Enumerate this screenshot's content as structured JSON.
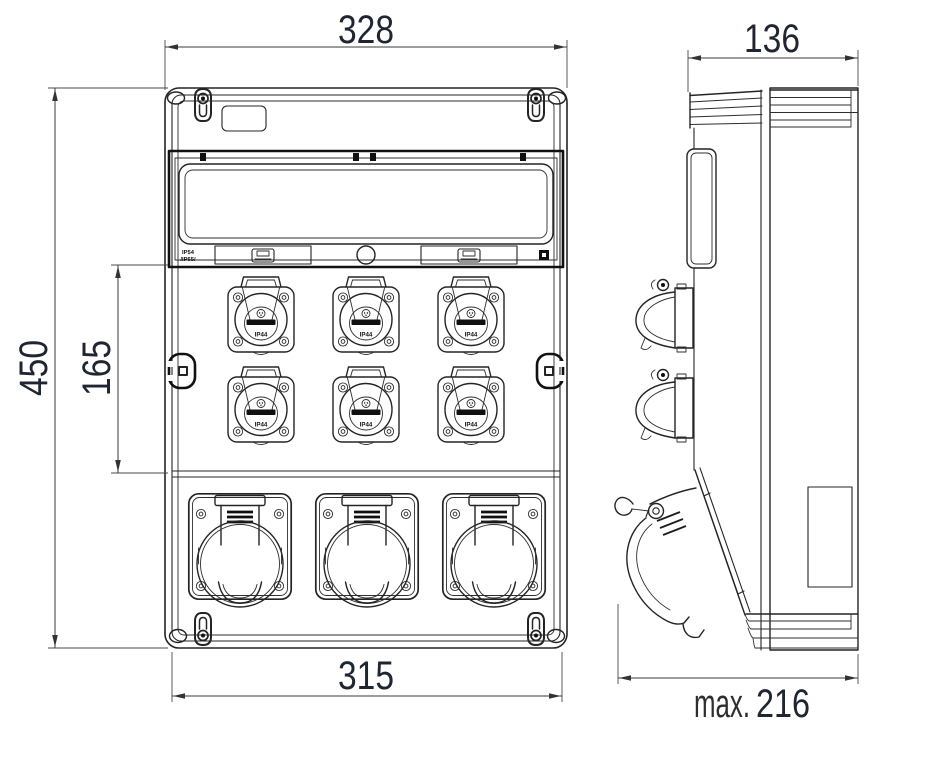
{
  "dimensions": {
    "front_width": "328",
    "side_width": "136",
    "front_height": "450",
    "schuko_field_height": "165",
    "mounting_width": "315",
    "max_depth_prefix": "max.",
    "max_depth_value": "216"
  },
  "labels": {
    "window_rating_top": "IP54",
    "window_rating_bottom": "/IP65/",
    "schuko_rating": "IP44"
  },
  "colors": {
    "line": "#242424",
    "dimension_text": "#1f2531",
    "background": "#ffffff"
  }
}
